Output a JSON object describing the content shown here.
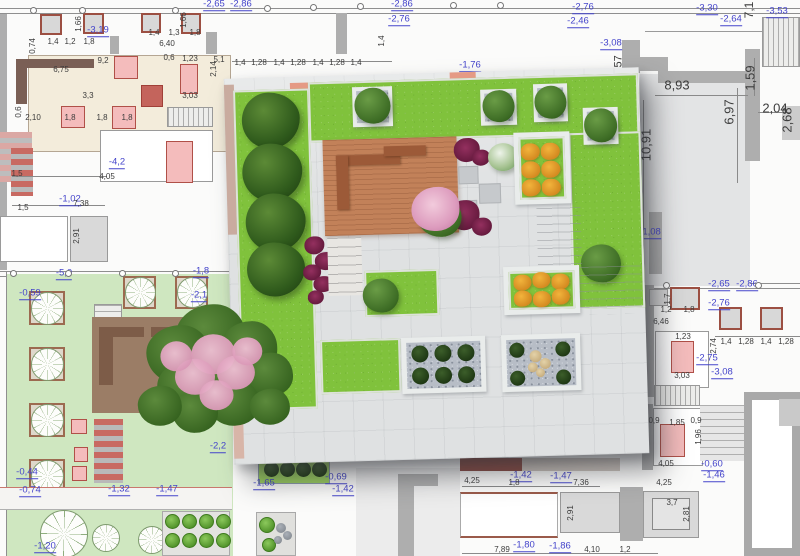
{
  "drawing": {
    "kind": "landscape-site-plan",
    "layers": {
      "base": "2D CAD plan with dimensions",
      "overlay": "3D rooftop garden render"
    }
  },
  "colors": {
    "elevation_blue": "#4444cb",
    "dimension_gray": "#3c3c3c",
    "grass_3d": "#80c23c",
    "grass_2d": "#cfe7c0",
    "deck_terracotta": "#c28159",
    "planter_pink": "#f4bcbc",
    "planter_border_red": "#9c4f42",
    "wall_gray": "#a8a8a8",
    "pavement": "#dfe1e2",
    "blossom_pink": "#dd9cbe"
  },
  "annotations": {
    "elevation_labels": [
      {
        "t": "-2,76",
        "x": 583,
        "y": 8
      },
      {
        "t": "-2,46",
        "x": 578,
        "y": 22
      },
      {
        "t": "-3,08",
        "x": 611,
        "y": 44
      },
      {
        "t": "-3,30",
        "x": 707,
        "y": 9
      },
      {
        "t": "-2,64",
        "x": 731,
        "y": 20
      },
      {
        "t": "-3,53",
        "x": 777,
        "y": 12
      },
      {
        "t": "-1,08",
        "x": 650,
        "y": 233
      },
      {
        "t": "-3,19",
        "x": 98,
        "y": 31
      },
      {
        "t": "-4,2",
        "x": 117,
        "y": 163
      },
      {
        "t": "-1,02",
        "x": 70,
        "y": 200
      },
      {
        "t": "-0,59",
        "x": 30,
        "y": 294
      },
      {
        "t": "-5,0",
        "x": 64,
        "y": 274
      },
      {
        "t": "-1,8",
        "x": 201,
        "y": 272
      },
      {
        "t": "-2,1",
        "x": 199,
        "y": 296
      },
      {
        "t": "-2,2",
        "x": 218,
        "y": 447
      },
      {
        "t": "-0,44",
        "x": 27,
        "y": 473
      },
      {
        "t": "-0,74",
        "x": 30,
        "y": 491
      },
      {
        "t": "-1,32",
        "x": 119,
        "y": 490
      },
      {
        "t": "-1,47",
        "x": 167,
        "y": 490
      },
      {
        "t": "-1,20",
        "x": 45,
        "y": 547
      },
      {
        "t": "-1,65",
        "x": 264,
        "y": 484
      },
      {
        "t": "-0,69",
        "x": 336,
        "y": 478
      },
      {
        "t": "-1,42",
        "x": 343,
        "y": 490
      },
      {
        "t": "-1,42",
        "x": 521,
        "y": 476
      },
      {
        "t": "-1,47",
        "x": 561,
        "y": 477
      },
      {
        "t": "-1,80",
        "x": 524,
        "y": 546
      },
      {
        "t": "-1,86",
        "x": 560,
        "y": 547
      },
      {
        "t": "-2,86",
        "x": 402,
        "y": 5
      },
      {
        "t": "-2,76",
        "x": 399,
        "y": 20
      },
      {
        "t": "-2,65",
        "x": 214,
        "y": 5
      },
      {
        "t": "-2,86",
        "x": 241,
        "y": 5
      },
      {
        "t": "-1,76",
        "x": 470,
        "y": 66
      },
      {
        "t": "-2,65",
        "x": 719,
        "y": 285
      },
      {
        "t": "-2,86",
        "x": 747,
        "y": 285
      },
      {
        "t": "-2,76",
        "x": 719,
        "y": 304
      },
      {
        "t": "-2,75",
        "x": 707,
        "y": 359
      },
      {
        "t": "-3,08",
        "x": 722,
        "y": 373
      },
      {
        "t": "-0,60",
        "x": 712,
        "y": 465
      },
      {
        "t": "-1,46",
        "x": 714,
        "y": 476
      }
    ],
    "dimension_labels": [
      {
        "t": "8,93",
        "x": 677,
        "y": 85,
        "s": 13
      },
      {
        "t": "6,97",
        "x": 729,
        "y": 112,
        "r": -90,
        "s": 13
      },
      {
        "t": "10,91",
        "x": 646,
        "y": 145,
        "r": -90,
        "s": 13
      },
      {
        "t": "1,59",
        "x": 750,
        "y": 78,
        "r": -90,
        "s": 13
      },
      {
        "t": "2,04",
        "x": 775,
        "y": 108,
        "s": 13
      },
      {
        "t": "2,68",
        "x": 787,
        "y": 120,
        "r": -90,
        "s": 13
      },
      {
        "t": "7,1",
        "x": 749,
        "y": 10,
        "r": -90,
        "s": 12
      },
      {
        "t": "1,57",
        "x": 619,
        "y": 66,
        "r": -90,
        "s": 11
      },
      {
        "t": "1,4",
        "x": 53,
        "y": 42
      },
      {
        "t": "1,2",
        "x": 70,
        "y": 42
      },
      {
        "t": "1,8",
        "x": 89,
        "y": 42
      },
      {
        "t": "0,74",
        "x": 33,
        "y": 46,
        "r": -90
      },
      {
        "t": "1,66",
        "x": 79,
        "y": 24,
        "r": -90
      },
      {
        "t": "1,4",
        "x": 154,
        "y": 33
      },
      {
        "t": "1,3",
        "x": 174,
        "y": 33
      },
      {
        "t": "1,8",
        "x": 195,
        "y": 33
      },
      {
        "t": "6,40",
        "x": 167,
        "y": 44
      },
      {
        "t": "1,66",
        "x": 184,
        "y": 20,
        "r": -90
      },
      {
        "t": "6,75",
        "x": 61,
        "y": 70
      },
      {
        "t": "9,2",
        "x": 103,
        "y": 61
      },
      {
        "t": "3,3",
        "x": 88,
        "y": 96
      },
      {
        "t": "2,10",
        "x": 33,
        "y": 118
      },
      {
        "t": "1,8",
        "x": 70,
        "y": 118
      },
      {
        "t": "1,8",
        "x": 102,
        "y": 118
      },
      {
        "t": "1,8",
        "x": 127,
        "y": 118
      },
      {
        "t": "0,6",
        "x": 19,
        "y": 112,
        "r": -90
      },
      {
        "t": "1,23",
        "x": 190,
        "y": 59
      },
      {
        "t": "3,03",
        "x": 190,
        "y": 96
      },
      {
        "t": "2,14",
        "x": 214,
        "y": 69,
        "r": -90
      },
      {
        "t": "5,1",
        "x": 219,
        "y": 60
      },
      {
        "t": "0,6",
        "x": 169,
        "y": 58
      },
      {
        "t": "1,4",
        "x": 240,
        "y": 63
      },
      {
        "t": "1,28",
        "x": 259,
        "y": 63
      },
      {
        "t": "1,4",
        "x": 279,
        "y": 63
      },
      {
        "t": "1,28",
        "x": 298,
        "y": 63
      },
      {
        "t": "1,4",
        "x": 318,
        "y": 63
      },
      {
        "t": "1,28",
        "x": 337,
        "y": 63
      },
      {
        "t": "1,4",
        "x": 356,
        "y": 63
      },
      {
        "t": "1,4",
        "x": 382,
        "y": 41,
        "r": -90
      },
      {
        "t": "4,05",
        "x": 107,
        "y": 177
      },
      {
        "t": "1,5",
        "x": 17,
        "y": 174
      },
      {
        "t": "7,38",
        "x": 81,
        "y": 204
      },
      {
        "t": "1,5",
        "x": 23,
        "y": 208
      },
      {
        "t": "2,91",
        "x": 77,
        "y": 236,
        "r": -90
      },
      {
        "t": "1,2",
        "x": 666,
        "y": 310
      },
      {
        "t": "1,8",
        "x": 689,
        "y": 310
      },
      {
        "t": "6,46",
        "x": 661,
        "y": 322
      },
      {
        "t": "1,23",
        "x": 683,
        "y": 337
      },
      {
        "t": "1,7",
        "x": 668,
        "y": 299,
        "r": -90
      },
      {
        "t": "2,74",
        "x": 714,
        "y": 346,
        "r": -90
      },
      {
        "t": "1,4",
        "x": 726,
        "y": 342
      },
      {
        "t": "1,28",
        "x": 746,
        "y": 342
      },
      {
        "t": "1,4",
        "x": 766,
        "y": 342
      },
      {
        "t": "1,28",
        "x": 786,
        "y": 342
      },
      {
        "t": "3,03",
        "x": 682,
        "y": 376
      },
      {
        "t": "0,9",
        "x": 654,
        "y": 421
      },
      {
        "t": "1,85",
        "x": 677,
        "y": 423
      },
      {
        "t": "0,9",
        "x": 696,
        "y": 421
      },
      {
        "t": "1,96",
        "x": 699,
        "y": 437,
        "r": -90
      },
      {
        "t": "4,05",
        "x": 666,
        "y": 464
      },
      {
        "t": "4,25",
        "x": 664,
        "y": 483
      },
      {
        "t": "3,7",
        "x": 672,
        "y": 503
      },
      {
        "t": "2,81",
        "x": 687,
        "y": 514,
        "r": -90
      },
      {
        "t": "4,25",
        "x": 472,
        "y": 481
      },
      {
        "t": "1,8",
        "x": 514,
        "y": 483
      },
      {
        "t": "7,36",
        "x": 581,
        "y": 483
      },
      {
        "t": "7,89",
        "x": 502,
        "y": 550
      },
      {
        "t": "4,10",
        "x": 592,
        "y": 550
      },
      {
        "t": "1,2",
        "x": 625,
        "y": 550
      },
      {
        "t": "2,91",
        "x": 571,
        "y": 513,
        "r": -90
      }
    ],
    "survey_points": [
      {
        "x": 33,
        "y": 10
      },
      {
        "x": 82,
        "y": 10
      },
      {
        "x": 175,
        "y": 10
      },
      {
        "x": 267,
        "y": 8
      },
      {
        "x": 313,
        "y": 7
      },
      {
        "x": 360,
        "y": 6
      },
      {
        "x": 453,
        "y": 5
      },
      {
        "x": 500,
        "y": 5
      },
      {
        "x": 13,
        "y": 273
      },
      {
        "x": 68,
        "y": 273
      },
      {
        "x": 122,
        "y": 273
      },
      {
        "x": 175,
        "y": 273
      },
      {
        "x": 666,
        "y": 285
      },
      {
        "x": 758,
        "y": 285
      }
    ]
  }
}
